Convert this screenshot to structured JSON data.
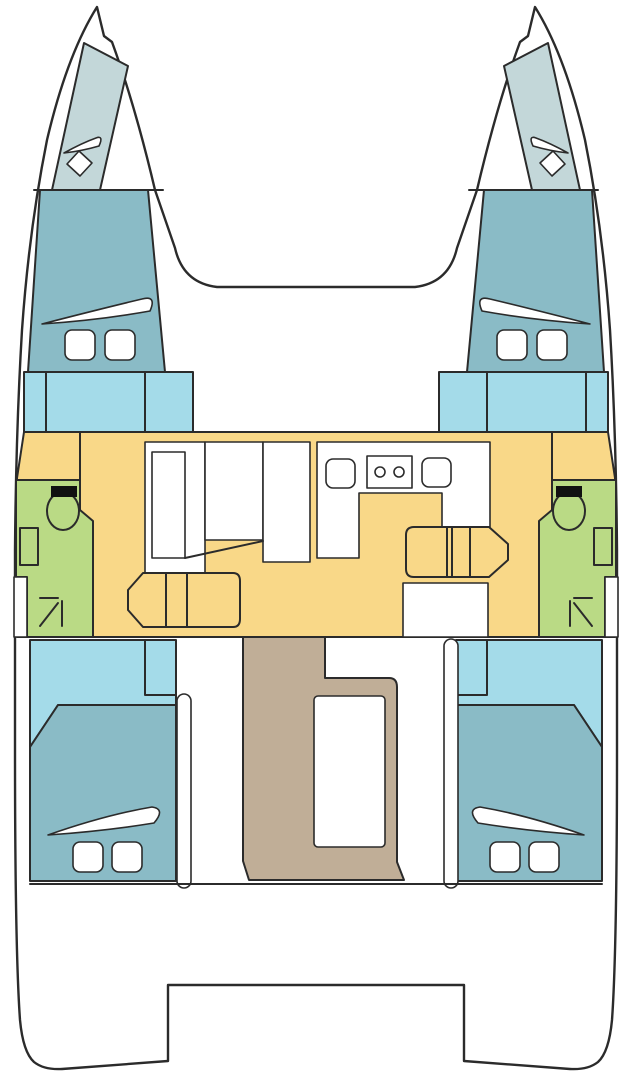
{
  "diagram": {
    "type": "boat-floor-plan",
    "subject": "Catamaran interior layout, top-down deck plan",
    "text_labels": [],
    "rooms": [
      {
        "id": "port-forepeak",
        "name": "Port bow forepeak locker"
      },
      {
        "id": "starboard-forepeak",
        "name": "Starboard bow forepeak locker"
      },
      {
        "id": "port-forward-cabin",
        "name": "Port forward cabin berth"
      },
      {
        "id": "starboard-forward-cabin",
        "name": "Starboard forward cabin berth"
      },
      {
        "id": "port-companionway",
        "name": "Port companionway / berth step section"
      },
      {
        "id": "starboard-companionway",
        "name": "Starboard companionway / berth step section"
      },
      {
        "id": "salon",
        "name": "Salon and galley sole"
      },
      {
        "id": "port-head",
        "name": "Port bathroom (head) with toilet, sink, shower"
      },
      {
        "id": "starboard-head",
        "name": "Starboard bathroom (head) with toilet, sink, shower"
      },
      {
        "id": "port-aft-cabin",
        "name": "Port aft cabin berth"
      },
      {
        "id": "starboard-aft-cabin",
        "name": "Starboard aft cabin berth"
      },
      {
        "id": "cockpit",
        "name": "Aft cockpit with table"
      },
      {
        "id": "transom",
        "name": "Stern platforms and transom steps"
      }
    ],
    "features": [
      "bow hatches",
      "deck hatches",
      "hull windows",
      "toilets",
      "sinks",
      "two-burner stove",
      "galley sinks",
      "salon sofa",
      "chaise seats",
      "sliding doors",
      "cockpit table",
      "berth pillows",
      "shower symbols"
    ]
  },
  "colors": {
    "outline": "#2b2b2b",
    "white": "#ffffff",
    "forepeak": "#c3d7d9",
    "cabin": "#8abbc6",
    "step": "#a4dbe9",
    "salon": "#f9d888",
    "head": "#bada85",
    "cockpit": "#c0ae97",
    "black": "#111111"
  }
}
